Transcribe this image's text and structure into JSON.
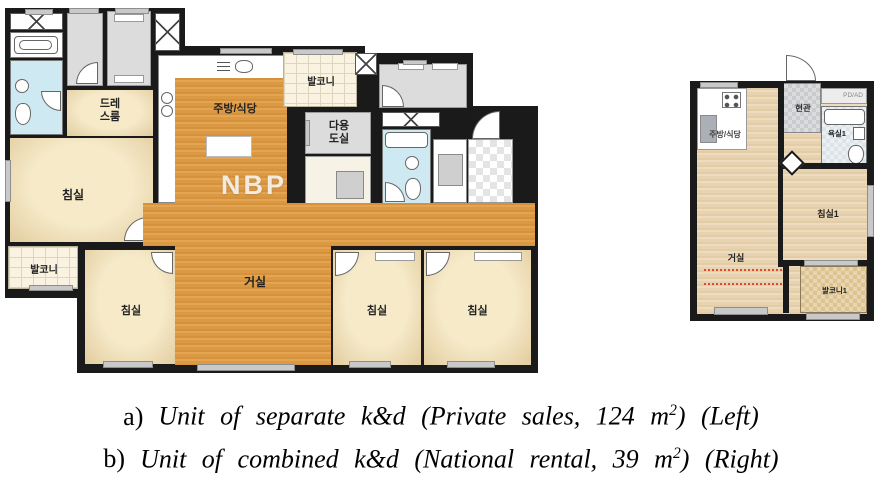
{
  "figure_type": "floor-plan-comparison",
  "colors": {
    "wall": "#1a1a1a",
    "wood_left_unit": "#dc9944",
    "wood_right_unit": "#e8d3b0",
    "bedroom_cream": "#f2e4c0",
    "bathroom_blue": "#cfe9f3",
    "utility_gray": "#dcdcdc",
    "heating_line_red": "#e4472e"
  },
  "left_plan": {
    "watermark": "NBP",
    "labels": {
      "dress_l1": "드레",
      "dress_l2": "스룸",
      "bedroom_master": "침실",
      "kitchen": "주방/식당",
      "balcony_top": "발코니",
      "utility_l1": "다용",
      "utility_l2": "도실",
      "balcony_left": "발코니",
      "bedroom_bottom_left": "침실",
      "living": "거실",
      "bedroom_bottom_mid": "침실",
      "bedroom_bottom_right": "침실"
    }
  },
  "right_plan": {
    "labels": {
      "entrance": "현관",
      "pd_ad": "PD/AD",
      "bath": "욕실1",
      "kitchen": "주방/식당",
      "bedroom": "침실1",
      "living": "거실",
      "balcony": "발코니1"
    }
  },
  "caption": {
    "lines": [
      {
        "prefix": "a)",
        "body": "Unit of separate k&d (Private sales, 124 m",
        "sup": "2",
        "tail": ") (Left)"
      },
      {
        "prefix": "b)",
        "body": "Unit of combined k&d (National rental, 39 m",
        "sup": "2",
        "tail": ") (Right)"
      }
    ]
  }
}
